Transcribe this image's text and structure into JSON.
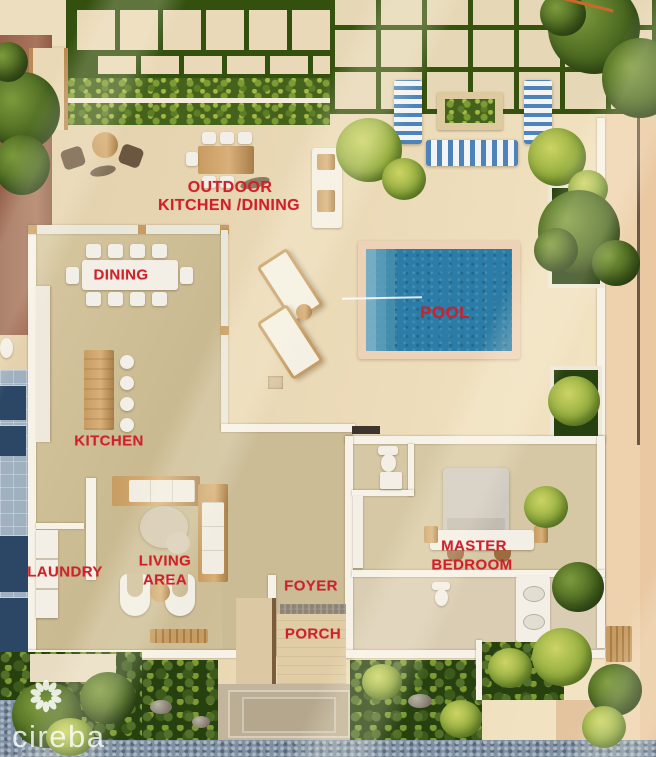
{
  "brand": {
    "name": "cireba",
    "icon": "flower-logo"
  },
  "rooms": {
    "outdoor_kitchen_line1": "OUTDOOR",
    "outdoor_kitchen_line2": "KITCHEN /DINING",
    "dining": "DINING",
    "pool": "POOL",
    "kitchen": "KITCHEN",
    "living_line1": "LIVING",
    "living_line2": "AREA",
    "laundry": "LAUNDRY",
    "master_line1": "MASTER",
    "master_line2": "BEDROOM",
    "foyer": "FOYER",
    "porch": "PORCH"
  },
  "colors": {
    "label_red": "#d2202a",
    "pool_water": "#2b7ca6",
    "hedge_green": "#33500f",
    "terrace_beige": "#e7d4b2",
    "watermark_white": "#ffffff"
  }
}
